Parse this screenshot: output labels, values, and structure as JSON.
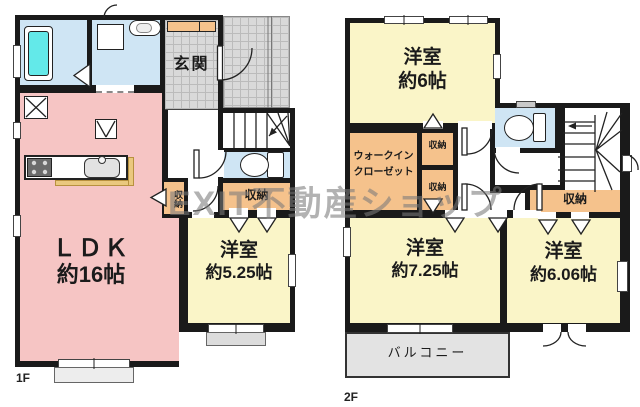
{
  "watermark": "EXIT不動産ショップ",
  "palette": {
    "wall": "#1a1a1a",
    "ldk_pink": "#f6c5c4",
    "room_yellow": "#faf5c8",
    "closet_orange": "#f5c28c",
    "wet_blue": "#cfe5f4",
    "tub_cyan": "#63e9e9",
    "tile_gray": "#d9d9d9",
    "balcony_gray": "#e3e3e3"
  },
  "floor1": {
    "label": "1F",
    "entrance": "玄関",
    "ldk": {
      "name": "ＬＤＫ",
      "size": "約16帖"
    },
    "bedroom": {
      "name": "洋室",
      "size": "約5.25帖"
    },
    "closet_wide": "収納",
    "closet_small": "収納"
  },
  "floor2": {
    "label": "2F",
    "bedroom_a": {
      "name": "洋室",
      "size": "約6帖"
    },
    "wic": {
      "line1": "ウォークイン",
      "line2": "クローゼット"
    },
    "closet_a": "収納",
    "closet_b": "収納",
    "closet_c": "収納",
    "bedroom_b": {
      "name": "洋室",
      "size": "約7.25帖"
    },
    "bedroom_c": {
      "name": "洋室",
      "size": "約6.06帖"
    },
    "balcony": "バルコニー"
  }
}
